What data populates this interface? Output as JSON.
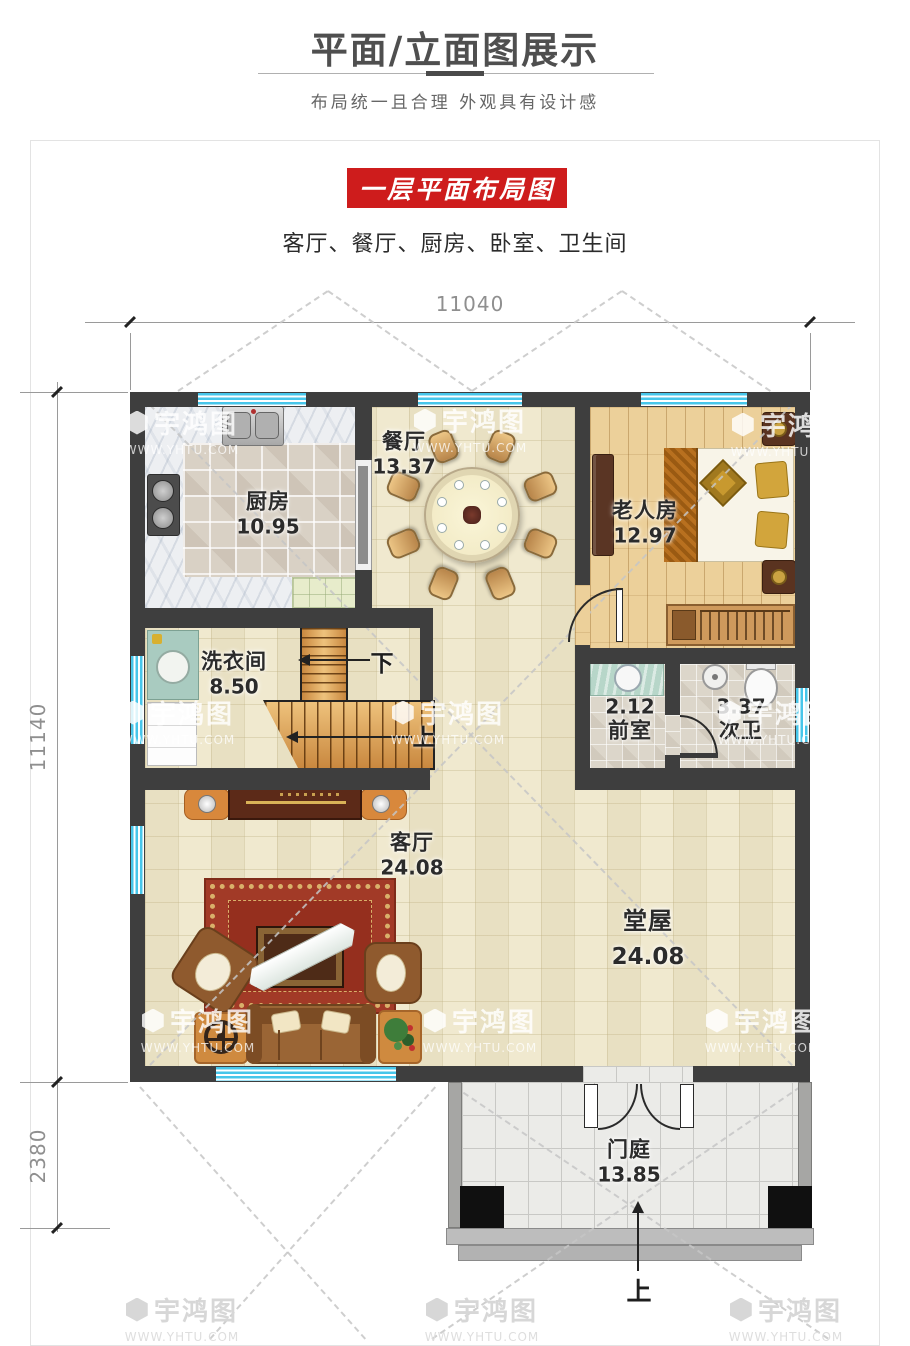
{
  "header": {
    "title": "平面/立面图展示",
    "subtitle": "布局统一且合理 外观具有设计感"
  },
  "section": {
    "banner_label": "一层平面布局图",
    "room_list": "客厅、餐厅、厨房、卧室、卫生间"
  },
  "dimensions": {
    "top_width": "11040",
    "left_height": "11140",
    "porch_depth": "2380"
  },
  "rooms": {
    "kitchen": {
      "name": "厨房",
      "area": "10.95"
    },
    "dining": {
      "name": "餐厅",
      "area": "13.37"
    },
    "elder_room": {
      "name": "老人房",
      "area": "12.97"
    },
    "laundry": {
      "name": "洗衣间",
      "area": "8.50"
    },
    "anteroom": {
      "name": "前室",
      "area": "2.12"
    },
    "second_bath": {
      "name": "次卫",
      "area": "3.37"
    },
    "living_room": {
      "name": "客厅",
      "area": "24.08"
    },
    "main_hall": {
      "name": "堂屋",
      "area": "24.08"
    },
    "porch": {
      "name": "门庭",
      "area": "13.85"
    }
  },
  "stairs": {
    "down_label": "下",
    "up_label": "上"
  },
  "entrance": {
    "direction_label": "上"
  },
  "watermark": {
    "brand": "宇鸿图",
    "site": "WWW.YHTU.COM"
  },
  "colors": {
    "banner_red": "#ce1c1c",
    "wall_dark": "#3e3e3e",
    "window_cyan": "#45c4e9",
    "floor_beige": "#f0e9cf",
    "stair_wood": "#dfa55e",
    "carpet_red": "#a23a27"
  }
}
